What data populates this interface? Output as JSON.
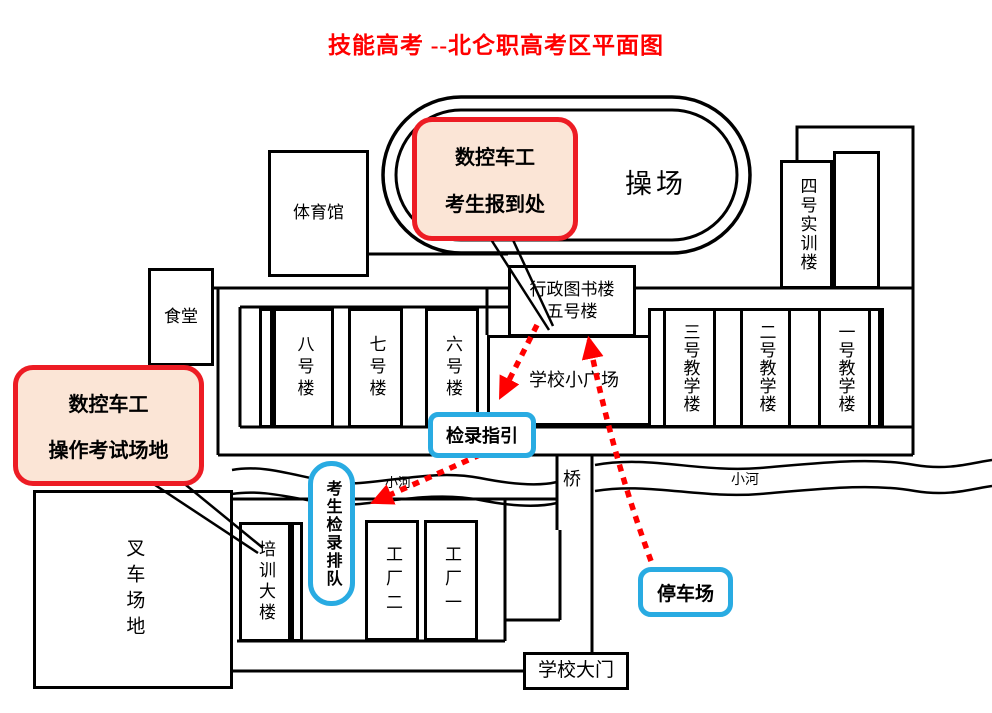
{
  "title": "技能高考 --北仑职高考区平面图",
  "colors": {
    "red_border": "#ED1C24",
    "red_fill": "#FBE5D6",
    "blue_border": "#29ABE2",
    "arrow_red": "#FF0000",
    "title_red": "#FF0000",
    "line_black": "#000000"
  },
  "playground": {
    "label": "操场"
  },
  "buildings": {
    "gym": "体育馆",
    "canteen": "食堂",
    "b8": "八号楼",
    "b7": "七号楼",
    "b6": "六号楼",
    "library_line1": "行政图书楼",
    "library_line2": "五号楼",
    "plaza": "学校小广场",
    "t3": "三号教学楼",
    "t2": "二号教学楼",
    "t1": "一号教学楼",
    "b4": "四号实训楼",
    "forklift": "叉车场地",
    "training": "培训大楼",
    "f2": "工厂二",
    "f1": "工厂一",
    "gate": "学校大门"
  },
  "callouts": {
    "report": {
      "line1": "数控车工",
      "line2": "考生报到处"
    },
    "exam": {
      "line1": "数控车工",
      "line2": "操作考试场地"
    },
    "guide": "检录指引",
    "queue": "考生检录排队",
    "parking": "停车场"
  },
  "labels": {
    "river": "小河",
    "bridge": "桥"
  }
}
